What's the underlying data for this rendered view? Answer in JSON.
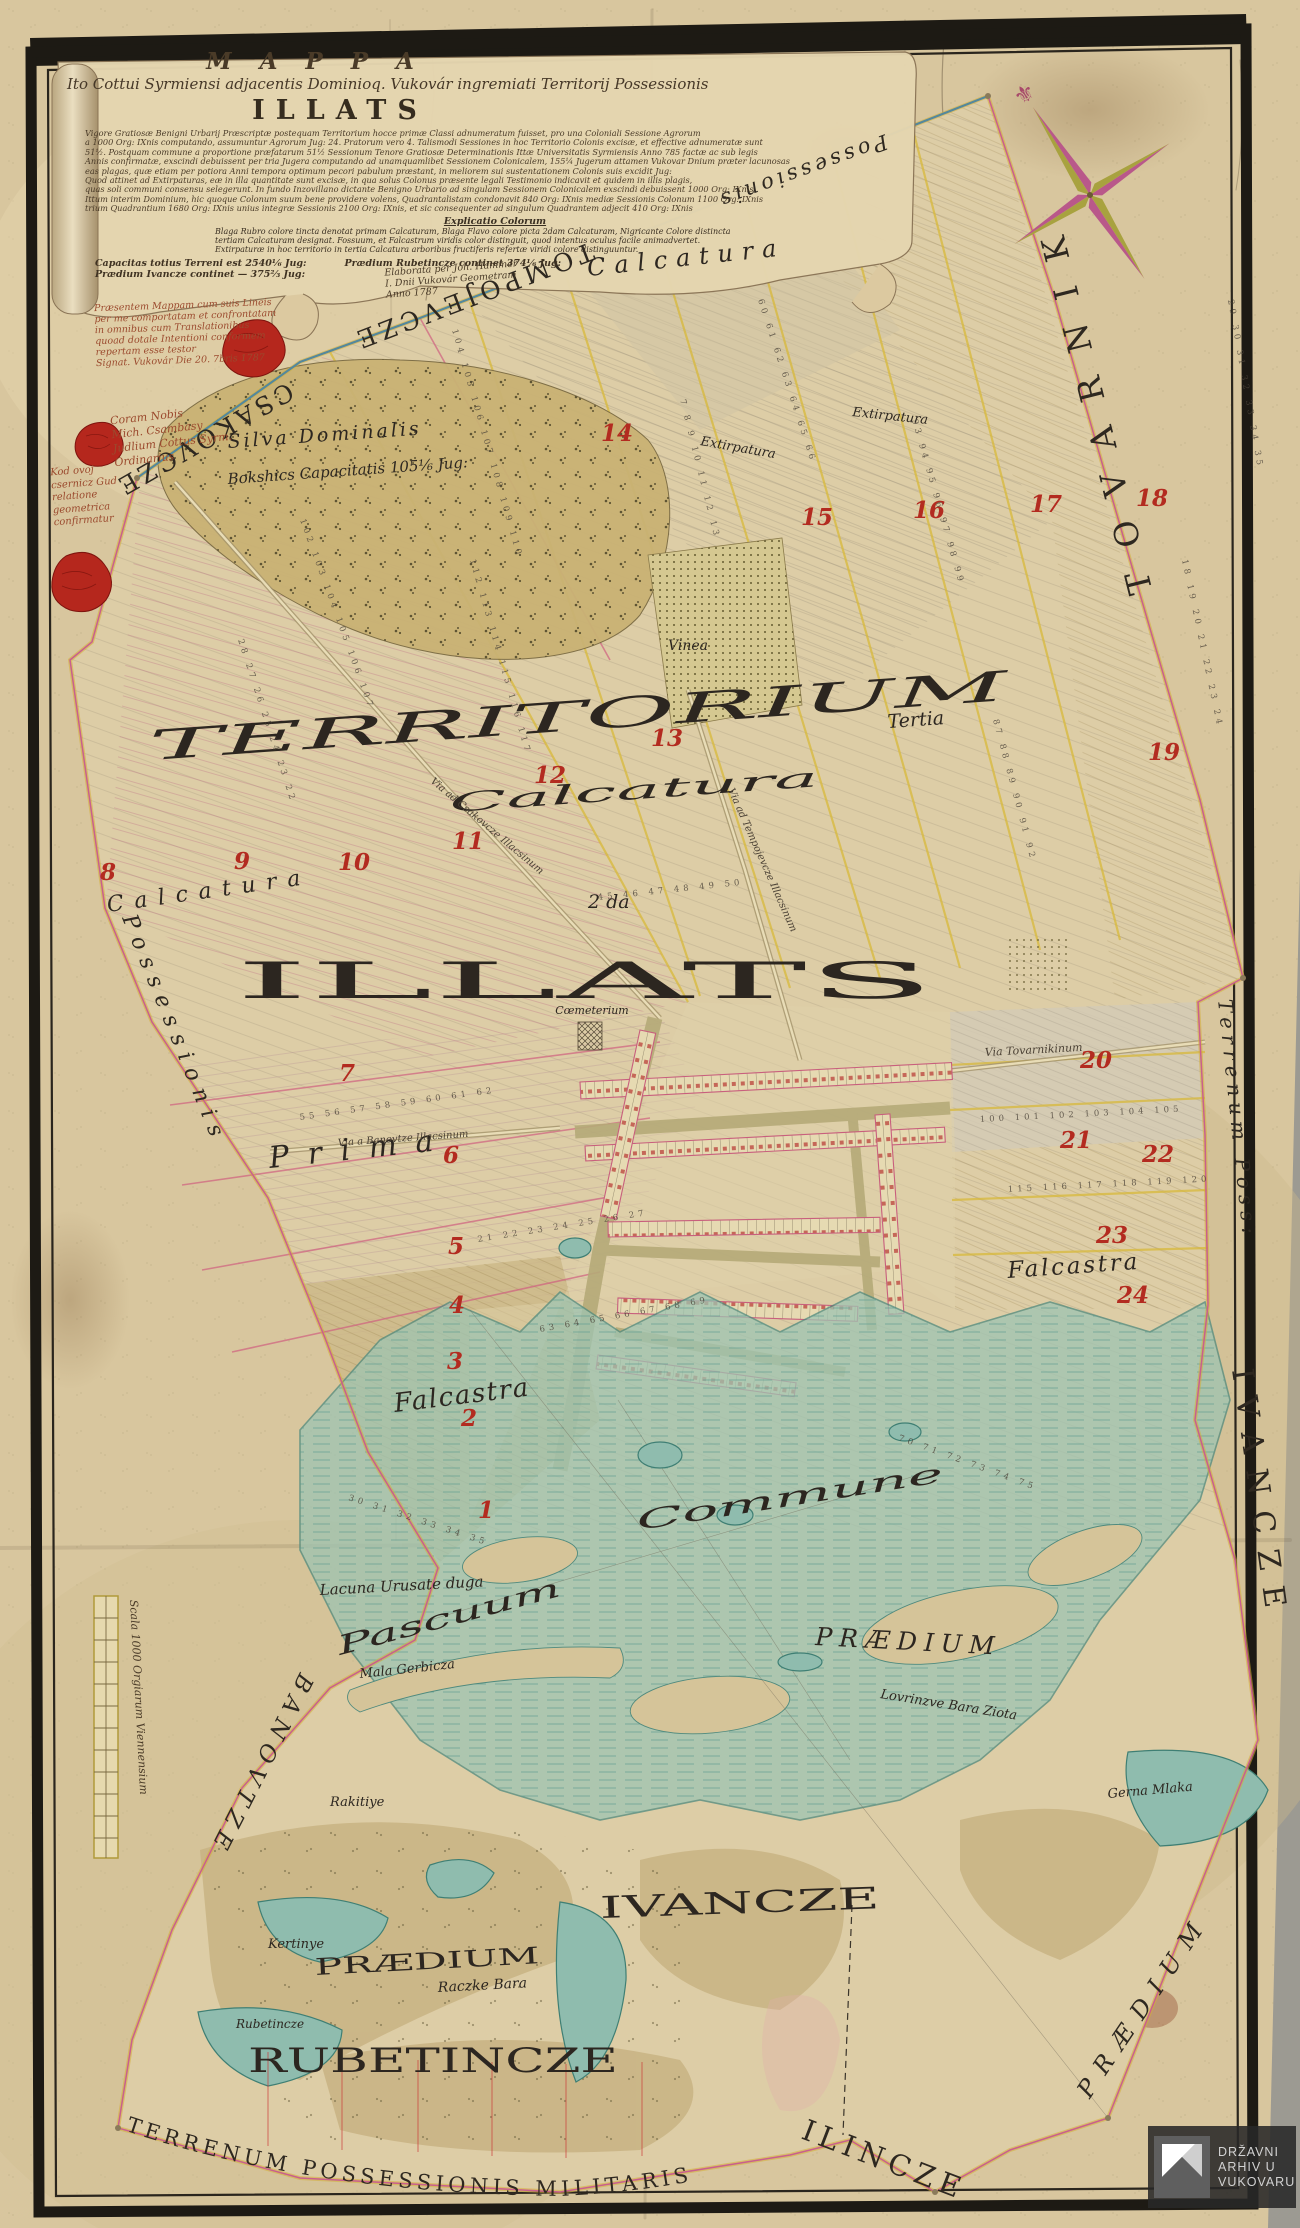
{
  "title_block": {
    "title": "M A P P A",
    "subtitle": "Ito Cottui Syrmiensi adjacentis Dominioq. Vukovár ingremiati Territorij Possessionis",
    "place_name": "ILLATS",
    "body_lines": [
      "Vigore Gratiosæ Benigni Urbarij Præscriptæ postequam Territorium hocce primæ Classi adnumeratum fuisset, pro una Coloniali Sessione Agrorum",
      "a 1000 Org: IXnis computando, assumuntur Agrorum Jug: 24. Pratorum vero 4. Talismodi Sessiones in hoc Territorio Colonis excisæ, et effective adnumeratæ sunt",
      "51½. Postquam commune a proportione præfatarum 51½ Sessionum Tenore Gratiosæ Determinationis Ittæ Universitatis Syrmiensis Anno 785 factæ ac sub legis",
      "Annis confirmatæ, exscindi debuissent per tria Jugera computando ad unamquamlibet Sessionem Colonicalem, 155¼ Jugerum attamen Vukovar Dnium præter lacunosas",
      "eas plagas, quæ etiam per potiora Anni tempora optimum pecori pabulum præstant, in meliorem sui sustentationem Colonis suis excidit Jug:",
      "Quod attinet ad Extirpaturas, eæ in illa quantitate sunt excisæ, in qua solus Colonus præsente legali Testimonio indicavit et quidem in illis plagis,",
      "quas soli communi consensu selegerunt. In fundo Inzovillano dictante Benigno Urbario ad singulam Sessionem Colonicalem exscindi debuissent 1000 Org: IXnis",
      "Ittum interim Dominium, hic quoque Colonum suum bene providere volens, Quadrantalistam condonavit 840 Org: IXnis mediæ Sessionis Colonum 1100 Org: IXnis",
      "trium Quadrantium 1680 Org: IXnis unius integræ Sessionis 2100 Org: IXnis, et sic consequenter ad singulum Quadrantem adjecit 410 Org: IXnis"
    ],
    "explicatio_heading": "Explicatio Colorum",
    "explicatio_lines": [
      "Blaga Rubro colore tincta denotat primam Calcaturam, Blaga Flavo colore picta 2dam Calcaturam, Nigricante Colore distincta",
      "tertiam Calcaturam designat. Fossuum, et Falcastrum viridis color distinguit, quod intentus oculus facile animadvertet.",
      "Extirpaturæ in hoc territorio in tertia Calcatura arboribus fructiferis refertæ viridi colore distinguuntur."
    ],
    "capacity_line1": "Capacitas totius Terreni est 2540⅙ Jug:",
    "capacity_line2": "Prædium Ivancze continet — 375⅔ Jug:",
    "capacity_line3": "Prædium Rubetincze continet 374⅙ Jug:",
    "signature_lines": [
      "Elaborata per Joh. Hammer",
      "I. Dnii Vukovár Geometram",
      "Anno 1787"
    ],
    "certification_lines": [
      "Præsentem Mappam cum suis Lineis",
      "per me comportatam et confrontatam",
      "in omnibus cum Translationibus",
      "quoad dotale Intentioni conformem",
      "repertam esse testor",
      "Signat. Vukovár Die 20. 7bris 1787"
    ],
    "coram_lines": [
      "Coram Nobis",
      "Mich. Csambasy",
      "Judlium Cottus Syrm.",
      "Ordinarius"
    ],
    "marginal_lines": [
      "Kod ovoj",
      "csernicz Gud",
      "relatione",
      "geometrica",
      "confirmatur"
    ]
  },
  "boundary_labels": {
    "csakovcze": "CSAKOVCZE",
    "tompojevcze": "TOMPOJEVCZE",
    "possessionis_top": "Possessionis",
    "tovarnik": "TOVARNIK",
    "terrenum_right": "Terrenum Poss:",
    "ivancze_edge": "IVANCZE",
    "praedium_se": "PRÆDIUM",
    "possessionis_west": "Possessionis",
    "banovtze": "BANOVTZE",
    "bottom_arc": "TERRENUM POSSESSIONIS MILITARIS",
    "ilincze": "ILINCZE"
  },
  "region_labels": {
    "territorium": "TERRITORIUM",
    "tertia": "Tertia",
    "illats": "ILLATS",
    "prima": "Prima",
    "calcatura_top": "Calcatura",
    "calcatura_mid": "Calcatura",
    "calcatura_left": "Calcatura",
    "secunda": "2 da",
    "extirpatura_a": "Extirpatura",
    "extirpatura_b": "Extirpatura",
    "falcastra_left": "Falcastra",
    "falcastra_right": "Falcastra",
    "silva_line1": "Silva Dominalis",
    "silva_line2": "Bokshics Capacitatis 105⅙ Jug:",
    "vinea": "Vinea",
    "coemeterium": "Cœmeterium",
    "pascuum": "Pascuum",
    "commune": "Commune",
    "ivancze": "IVANCZE",
    "rubetincze": "RUBETINCZE",
    "praedium_sw": "PRÆDIUM",
    "praedium_mid": "PRÆDIUM",
    "lacuna": "Lacuna Urusate duga",
    "mala_gerbicza": "Mala Gerbicza",
    "gerna_mlaka": "Gerna Mlaka",
    "rakitiye": "Rakitiye",
    "kertinye": "Kertinye",
    "raczke_bara": "Raczke Bara",
    "rubetincze_small": "Rubetincze",
    "lovrinzve": "Lovrinzve Bara Ziota"
  },
  "road_labels": {
    "to_csakovcze": "Via ad Csakovcze Illacsinum",
    "to_tempojevcze": "Via ad Tempojevcze Illacsinum",
    "to_tovarnik": "Via Tovarnikinum",
    "to_banovtze": "Via a Banovtze Illacsinum"
  },
  "scale_bar": {
    "caption": "Scala 1000 Orgiarum Viennensium"
  },
  "archive_watermark": {
    "line1": "DRŽAVNI",
    "line2": "ARHIV U",
    "line3": "VUKOVARU"
  },
  "colors": {
    "paper": "#d8c69e",
    "frame": "#1d1a14",
    "boundary_pink": "#c95f8d",
    "boundary_yellow": "#d4af37",
    "boundary_blue": "#55889b",
    "marsh": "#9ec4b2",
    "forest": "#c9b274",
    "seal_red": "#b5271d",
    "red_number": "#b32b20",
    "street": "#b5aa78"
  },
  "red_numbers": [
    {
      "n": "1",
      "x": 478,
      "y": 1518
    },
    {
      "n": "2",
      "x": 461,
      "y": 1426
    },
    {
      "n": "3",
      "x": 447,
      "y": 1369
    },
    {
      "n": "4",
      "x": 449,
      "y": 1313
    },
    {
      "n": "5",
      "x": 448,
      "y": 1254
    },
    {
      "n": "6",
      "x": 443,
      "y": 1163
    },
    {
      "n": "7",
      "x": 339,
      "y": 1081
    },
    {
      "n": "8",
      "x": 100,
      "y": 880
    },
    {
      "n": "9",
      "x": 234,
      "y": 869
    },
    {
      "n": "10",
      "x": 338,
      "y": 870
    },
    {
      "n": "11",
      "x": 452,
      "y": 849
    },
    {
      "n": "12",
      "x": 534,
      "y": 783
    },
    {
      "n": "13",
      "x": 651,
      "y": 746
    },
    {
      "n": "14",
      "x": 601,
      "y": 441
    },
    {
      "n": "15",
      "x": 801,
      "y": 525
    },
    {
      "n": "16",
      "x": 913,
      "y": 518
    },
    {
      "n": "17",
      "x": 1030,
      "y": 512
    },
    {
      "n": "18",
      "x": 1136,
      "y": 506
    },
    {
      "n": "19",
      "x": 1148,
      "y": 760
    },
    {
      "n": "20",
      "x": 1080,
      "y": 1068
    },
    {
      "n": "21",
      "x": 1060,
      "y": 1148
    },
    {
      "n": "22",
      "x": 1142,
      "y": 1162
    },
    {
      "n": "23",
      "x": 1096,
      "y": 1243
    },
    {
      "n": "24",
      "x": 1117,
      "y": 1303
    }
  ],
  "tiny_number_rows": [
    {
      "t": "28 27 26 25 24 23 22",
      "x": 238,
      "y": 640,
      "r": 72
    },
    {
      "t": "112 113 114 115 116 117",
      "x": 470,
      "y": 560,
      "r": 74
    },
    {
      "t": "104 105 106 107 108 109 110",
      "x": 452,
      "y": 330,
      "r": 74
    },
    {
      "t": "60 61 62 63 64 65 66",
      "x": 758,
      "y": 300,
      "r": 72
    },
    {
      "t": "93 94 95 96 97 98 99",
      "x": 912,
      "y": 420,
      "r": 74
    },
    {
      "t": "18 19 20 21 22 23 24",
      "x": 1182,
      "y": 560,
      "r": 78
    },
    {
      "t": "29 30 31 32 33 34 35",
      "x": 1228,
      "y": 300,
      "r": 80
    },
    {
      "t": "87 88 89 90 91 92",
      "x": 993,
      "y": 720,
      "r": 75
    },
    {
      "t": "55 56 57 58 59 60 61 62",
      "x": 300,
      "y": 1120,
      "r": -8
    },
    {
      "t": "21 22 23 24 25 26 27",
      "x": 478,
      "y": 1242,
      "r": -9
    },
    {
      "t": "63 64 65 66 67 68 69",
      "x": 540,
      "y": 1332,
      "r": -10
    },
    {
      "t": "100 101 102 103 104 105",
      "x": 980,
      "y": 1122,
      "r": -3
    },
    {
      "t": "115 116 117 118 119 120",
      "x": 1008,
      "y": 1192,
      "r": -3
    },
    {
      "t": "102 103 104 105 106 107",
      "x": 300,
      "y": 520,
      "r": 70
    },
    {
      "t": "7 8 9 10 11 12 13",
      "x": 680,
      "y": 400,
      "r": 76
    },
    {
      "t": "45 46 47 48 49 50",
      "x": 598,
      "y": 900,
      "r": -6
    },
    {
      "t": "70 71 72 73 74 75",
      "x": 898,
      "y": 1440,
      "r": 20
    },
    {
      "t": "30 31 32 33 34 35",
      "x": 348,
      "y": 1500,
      "r": 18
    }
  ]
}
